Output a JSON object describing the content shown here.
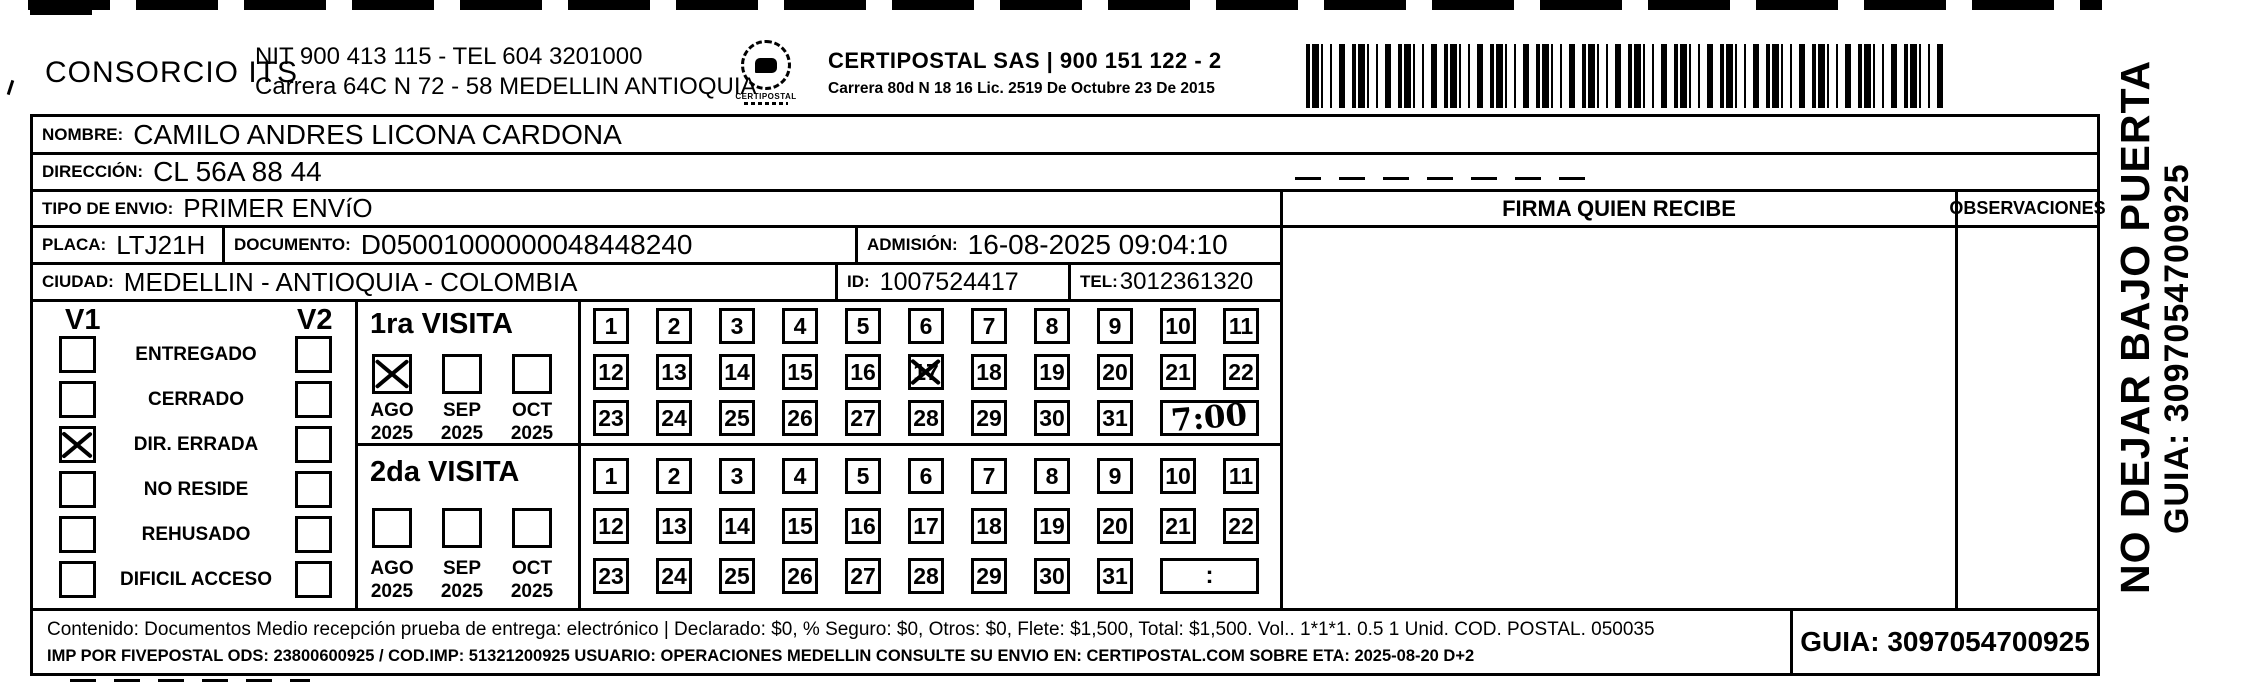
{
  "letterhead": {
    "company": "CONSORCIO ITS",
    "nit_line": "NIT 900 413 115 - TEL 604 3201000",
    "address_line": "Carrera 64C N 72 - 58 MEDELLIN ANTIOQUIA",
    "logo_text": "CERTIPOSTAL",
    "certipostal_line": "CERTIPOSTAL SAS | 900 151 122 - 2",
    "certipostal_address": "Carrera 80d N 18 16  Lic. 2519 De Octubre 23 De 2015",
    "barcode_icon": "barcode"
  },
  "recipient": {
    "nombre_label": "NOMBRE:",
    "nombre": "CAMILO ANDRES LICONA CARDONA",
    "direccion_label": "DIRECCIÓN:",
    "direccion": "CL 56A  88 44",
    "tipo_envio_label": "TIPO DE ENVIO:",
    "tipo_envio": "PRIMER ENVíO",
    "placa_label": "PLACA:",
    "placa": "LTJ21H",
    "documento_label": "DOCUMENTO:",
    "documento": "D05001000000048448240",
    "admision_label": "ADMISIÓN:",
    "admision": "16-08-2025 09:04:10",
    "ciudad_label": "CIUDAD:",
    "ciudad": "MEDELLIN - ANTIOQUIA - COLOMBIA",
    "id_label": "ID:",
    "id": "1007524417",
    "tel_label": "TEL:",
    "tel": "3012361320"
  },
  "signature": {
    "firma_header": "FIRMA QUIEN RECIBE",
    "observaciones_header": "OBSERVACIONES"
  },
  "status": {
    "v1_header": "V1",
    "v2_header": "V2",
    "items": [
      {
        "label": "ENTREGADO",
        "v1": false,
        "v2": false
      },
      {
        "label": "CERRADO",
        "v1": false,
        "v2": false
      },
      {
        "label": "DIR. ERRADA",
        "v1": true,
        "v2": false
      },
      {
        "label": "NO RESIDE",
        "v1": false,
        "v2": false
      },
      {
        "label": "REHUSADO",
        "v1": false,
        "v2": false
      },
      {
        "label": "DIFICIL ACCESO",
        "v1": false,
        "v2": false
      }
    ]
  },
  "visits": [
    {
      "title": "1ra VISITA",
      "months": [
        {
          "label": "AGO",
          "year": "2025",
          "checked": true
        },
        {
          "label": "SEP",
          "year": "2025",
          "checked": false
        },
        {
          "label": "OCT",
          "year": "2025",
          "checked": false
        }
      ],
      "day_rows": [
        [
          1,
          2,
          3,
          4,
          5,
          6,
          7,
          8,
          9,
          10,
          11
        ],
        [
          12,
          13,
          14,
          15,
          16,
          17,
          18,
          19,
          20,
          21,
          22
        ],
        [
          23,
          24,
          25,
          26,
          27,
          28,
          29,
          30,
          31
        ]
      ],
      "crossed_days": [
        17
      ],
      "time_value": "7:00"
    },
    {
      "title": "2da VISITA",
      "months": [
        {
          "label": "AGO",
          "year": "2025",
          "checked": false
        },
        {
          "label": "SEP",
          "year": "2025",
          "checked": false
        },
        {
          "label": "OCT",
          "year": "2025",
          "checked": false
        }
      ],
      "day_rows": [
        [
          1,
          2,
          3,
          4,
          5,
          6,
          7,
          8,
          9,
          10,
          11
        ],
        [
          12,
          13,
          14,
          15,
          16,
          17,
          18,
          19,
          20,
          21,
          22
        ],
        [
          23,
          24,
          25,
          26,
          27,
          28,
          29,
          30,
          31
        ]
      ],
      "crossed_days": [],
      "time_value": ":"
    }
  ],
  "footer": {
    "contenido_line": "Contenido: Documentos Medio recepción prueba de entrega: electrónico | Declarado: $0, % Seguro: $0, Otros: $0, Flete: $1,500, Total: $1,500. Vol.. 1*1*1. 0.5  1 Unid. COD. POSTAL. 050035",
    "imp_line": "IMP POR FIVEPOSTAL ODS: 23800600925 / COD.IMP: 51321200925 USUARIO: OPERACIONES MEDELLIN CONSULTE SU ENVIO EN: CERTIPOSTAL.COM SOBRE ETA: 2025-08-20 D+2",
    "guia": "GUIA: 3097054700925"
  },
  "side_labels": {
    "no_dejar": "NO DEJAR BAJO PUERTA",
    "guia": "GUIA: 3097054700925"
  },
  "colors": {
    "ink": "#000000",
    "paper": "#ffffff"
  }
}
